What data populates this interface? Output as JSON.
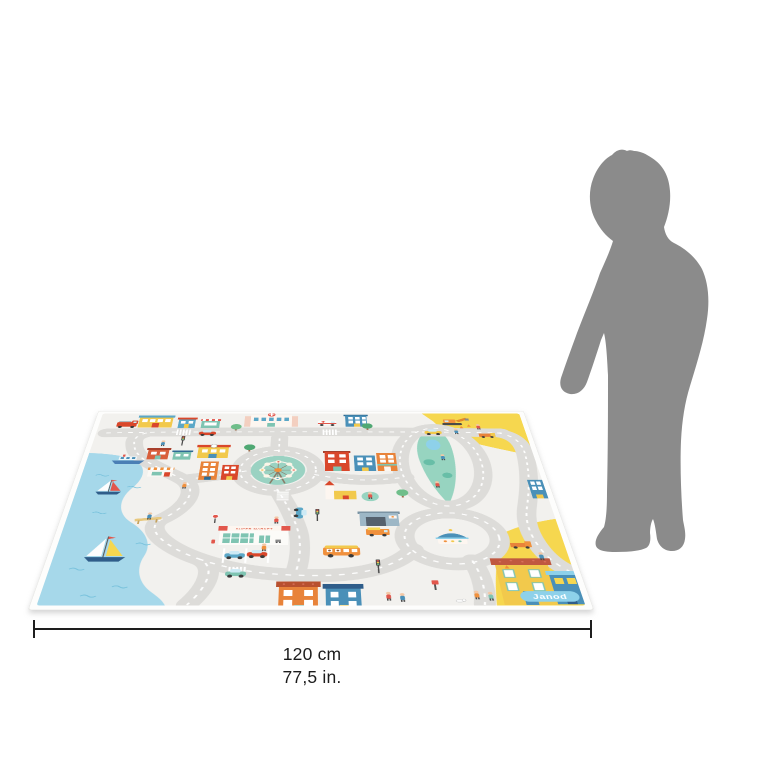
{
  "canvas": {
    "background": "#ffffff",
    "width_px": 762,
    "height_px": 762
  },
  "dimension_annotation": {
    "metric_label": "120 cm",
    "imperial_label": "77,5 in.",
    "line_color": "#1e1e1e"
  },
  "play_mat": {
    "brand_label": "Janod",
    "supermarket_sign": "SUPER MARKET",
    "colors": {
      "mat_background": "#f2f1ee",
      "border": "#ffffff",
      "road": "#dddcd9",
      "road_marking": "#ffffff",
      "water": "#a6d8ea",
      "wave_blue": "#79c2dc",
      "construction_yellow": "#f6d74f",
      "park_green": "#97d4c0",
      "brick_red": "#d9472b",
      "house_orange": "#e8833a",
      "house_blue": "#4a90b8",
      "house_teal": "#7fc4b2",
      "house_yellow": "#f2c94c",
      "logo_blue": "#8ed1ea"
    }
  },
  "size_reference": {
    "figure": "child-silhouette",
    "color": "#8b8b8b"
  }
}
